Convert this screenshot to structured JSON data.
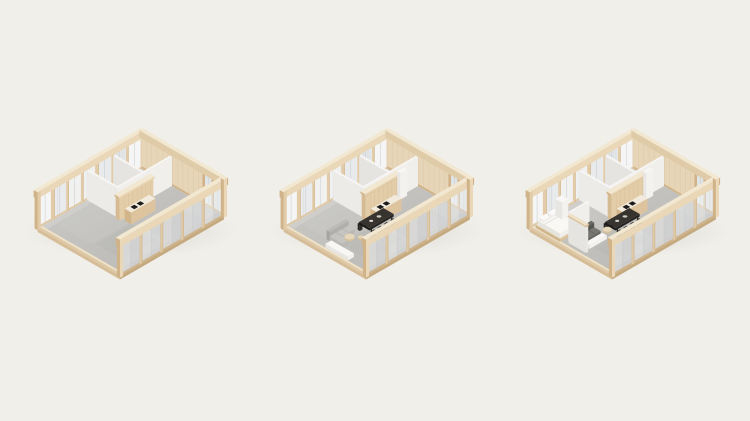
{
  "page": {
    "background_color": "#f0efe9",
    "width": 750,
    "height": 421,
    "content": "three-stage isometric apartment interior diagram, no visible text"
  },
  "figure": {
    "type": "isometric-architectural-diagram",
    "units": [
      {
        "id": "unit-a",
        "label": "empty-shell-with-kitchen-core",
        "furnishings": [
          "service-core",
          "kitchen-cabinets",
          "kitchen-island"
        ]
      },
      {
        "id": "unit-b",
        "label": "furnished-open-plan",
        "furnishings": [
          "service-core",
          "kitchen-cabinets",
          "kitchen-island",
          "fridge-door",
          "dining-table",
          "sofa-light"
        ]
      },
      {
        "id": "unit-c",
        "label": "furnished-with-bedroom",
        "furnishings": [
          "service-core",
          "kitchen-cabinets",
          "kitchen-island",
          "fridge-door",
          "dining-table",
          "sofa-dark",
          "bedroom-walls"
        ]
      }
    ]
  },
  "colors": {
    "background": "#f0efe9",
    "beam_top": "#f2e7d0",
    "beam_front": "#e9d7b7",
    "beam_side": "#e0cba9",
    "wood_mid": "#dfc8a5",
    "wood_dark": "#d0b389",
    "wood_deep": "#c2a277",
    "stud": "#e2cba9",
    "panel_wood": "#e7d5b7",
    "panel_line": "#d6bf9b",
    "floor_light": "#cccbc8",
    "floor_dark": "#b7b6b3",
    "slab_side": "#d6bd97",
    "slab_front": "#c5aa80",
    "glass_a": "#f4f5f4",
    "glass_b": "#e8eaec",
    "glass_c": "#eff1f0",
    "glass_d": "#e1e4e6",
    "glass_e": "#f1f1ef",
    "mullion": "#c5c9cc",
    "partition_front": "#f0efec",
    "partition_side": "#e5e4e1",
    "partition_top": "#f6f5f3",
    "partition_end": "#eae8e5",
    "cabinet": "#e3cda9",
    "cabinet_side": "#d6bb92",
    "cabinet_line": "#cdaf83",
    "cabinet_top": "#efe2c6",
    "cap_front": "#e9d6b4",
    "counter_top": "#f2ebdd",
    "island_front": "#ddc49e",
    "island_side": "#d2b58a",
    "cooktop": "#1d1c1b",
    "dark_table": "#262422",
    "dark_table_top": "#37332e",
    "dark_table_side": "#1d1b1a",
    "chair": "#2d2b28",
    "chair_top": "#3c3833",
    "sofa2_back": "#b0afac",
    "sofa2_back_side": "#a5a4a1",
    "sofa2_top": "#bcbbb8",
    "sofa2_seat": "#c6c5c2",
    "sofa2_seat_side": "#b9b8b5",
    "sofa3_back": "#57554f",
    "sofa3_back_side": "#4a4843",
    "sofa3_top": "#6a6861",
    "sofa3_seat": "#787670",
    "sofa3_seat_side": "#686660",
    "white_furn": "#f3f2ef",
    "white_furn_side": "#e7e6e3",
    "white_furn_top": "#f8f7f5",
    "bed_base": "#dcc29b",
    "bed_base_side": "#cfb58c",
    "bed_base_top": "#e9dabd",
    "mattress": "#f1efeb",
    "mattress_side": "#e6e4df",
    "mattress_top": "#f7f6f2",
    "pillow": "#fbfaf8",
    "round_top": "#e7d8bb",
    "round_side": "#d5c099"
  }
}
